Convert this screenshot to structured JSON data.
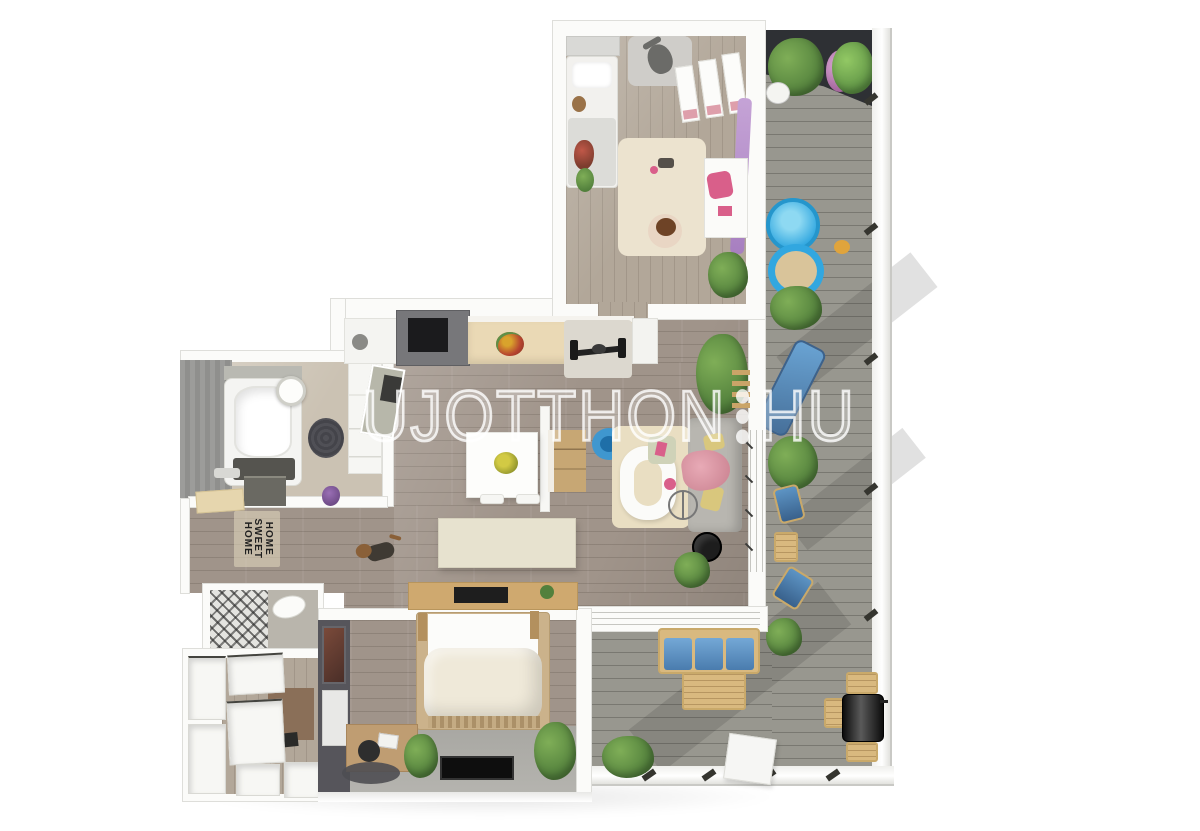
{
  "watermark": {
    "main": "UJOTTHON",
    "suffix": "HU",
    "separator_icon": "vertical-three-dots"
  },
  "doormat": {
    "lines": [
      "HOME",
      "SWEET",
      "HOME"
    ]
  },
  "palette": {
    "wall": "#fbfbf9",
    "wall_edge": "#dededa",
    "wood": "#a0948a",
    "kids_wood": "#b2a799",
    "deck": "#98978f",
    "bath_floor": "#cbc2b3",
    "bath_wall": "#97979a",
    "dark_wall": "#56555b",
    "counter": "#ead9b5",
    "island": "#c7a774",
    "cream": "#e7e2cf",
    "rug_beige": "#e9dec2",
    "sofa_gray": "#b8b6b0",
    "blue": "#4f93c8",
    "pool_blue": "#31a7e0",
    "pink": "#de9fab",
    "magenta": "#d95f8a",
    "purple": "#b18cc4",
    "green": "#52803c",
    "green_light": "#7fae57",
    "wood_furn": "#d9b97f",
    "yellow": "#d9c77d",
    "black": "#1d1d1d",
    "watermark": "rgba(255,255,255,0.8)"
  }
}
